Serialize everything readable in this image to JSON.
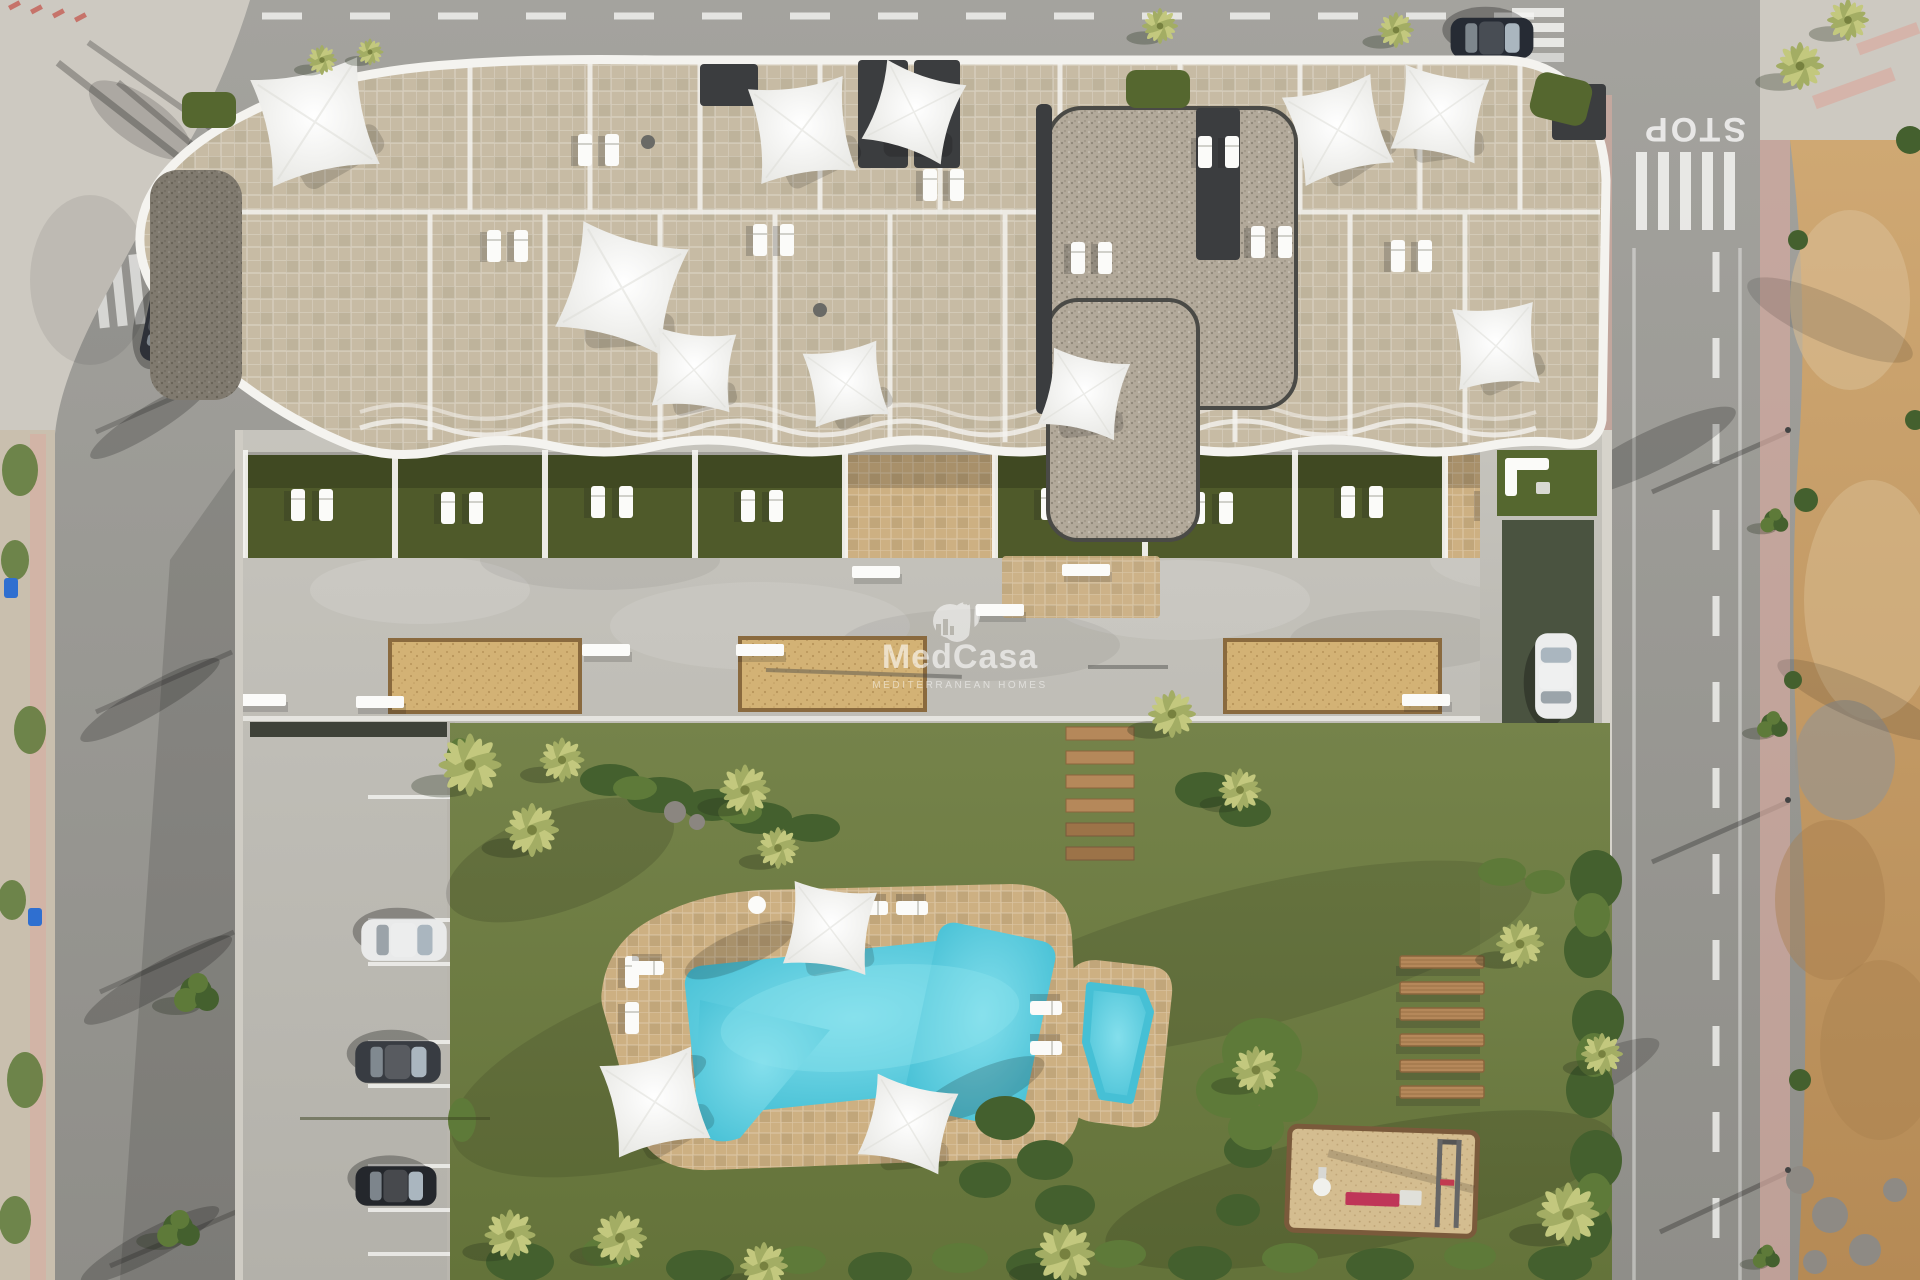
{
  "watermark": {
    "logo": "palm-circle-icon",
    "brand": "MedCasa",
    "tagline": "MEDITERRANEAN HOMES"
  },
  "road_markings": {
    "stop": "STOP"
  },
  "scene": {
    "description": "Aerial 3D render of a residential apartment complex: rooftop terraces with white shade sails, ground-floor lawn terraces, concrete promenade with sand planters, communal garden with free-form pool, splash pool, wooden steps, benches, playground, street parking with cars, surrounding roads and an undeveloped dirt lot"
  },
  "colors": {
    "asphalt": "#9b9a95",
    "asphalt_dark": "#7e7d79",
    "sidewalk": "#cdc9c1",
    "sidewalk_pink": "#d8aba0",
    "dirt": "#c29b67",
    "dirt_light": "#d9bd92",
    "dirt_dark": "#a87f4e",
    "lawn": "#6f7e41",
    "lawn_dark": "#5c6b34",
    "terrace_lawn": "#4f5a2a",
    "concrete": "#bcbab4",
    "concrete_light": "#cccac4",
    "planter_sand": "#d3b275",
    "planter_sand_dark": "#b8945a",
    "deck_sand": "#cdb082",
    "pool_water": "#55cde0",
    "pool_water_light": "#8ce4ee",
    "roof_tile": "#c7bba4",
    "roof_tile_dark": "#b5a890",
    "gravel": "#b2a99a",
    "gravel_dot": "#8f8778",
    "parapet_white": "#f4f3ef",
    "sail_white": "#fbfbf9",
    "stair_dark": "#3b3d3f",
    "roof_garden": "#55672f",
    "wood": "#b5885a",
    "wood_dark": "#8a653c",
    "play_sand": "#d4bd90",
    "bush": "#44602e",
    "bush_light": "#5e7a39",
    "palm": "#a3ad64",
    "palm_light": "#c3c87e",
    "marking_white": "#f5f5f2",
    "marking_red": "#c4574e",
    "driveway_green": "#4a5340",
    "car_dark": "#2b2f36",
    "car_white": "#e9eaea",
    "bin_blue": "#2f6fd0"
  }
}
